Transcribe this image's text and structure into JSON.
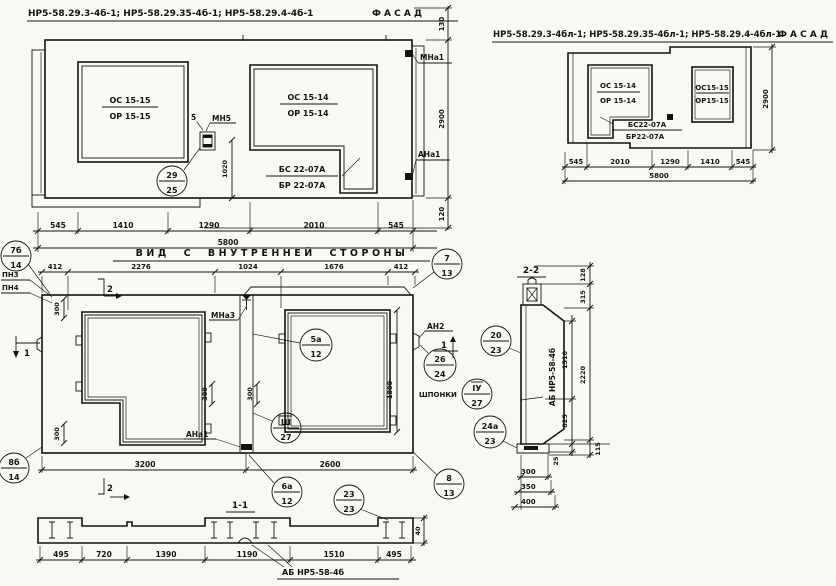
{
  "f1": {
    "title": "НР5-58.29.3-4б-1; НР5-58.29.35-4б-1; НР5-58.29.4-4б-1",
    "fasad": "Ф А С А Д",
    "w1a": "ОС 15-15",
    "w1b": "ОР 15-15",
    "w2a": "ОС 15-14",
    "w2b": "ОР 15-14",
    "sa": "БС 22-07А",
    "sb": "БР 22-07А",
    "mn5": "МН5",
    "n5": "5",
    "mna1": "МНа1",
    "ana1": "АНа1",
    "dims": [
      "545",
      "1410",
      "1290",
      "2010",
      "545"
    ],
    "total": "5800",
    "d130": "130",
    "d2900": "2900",
    "d120": "120",
    "d1020": "1020",
    "c29": {
      "a": "29",
      "b": "25"
    }
  },
  "f2": {
    "title": "НР5-58.29.3-4бл-1; НР5-58.29.35-4бл-1; НР5-58.29.4-4бл-1",
    "fasad": "Ф А С А Д",
    "w1a": "ОС 15-14",
    "w1b": "ОР 15-14",
    "w2a": "ОС15-15",
    "w2b": "ОР15-15",
    "sa": "БС22-07А",
    "sb": "БР22-07А",
    "dims": [
      "545",
      "2010",
      "1290",
      "1410",
      "545"
    ],
    "total": "5800",
    "d2900": "2900"
  },
  "iv": {
    "title": "ВИД С ВНУТРЕННЕЙ СТОРОНЫ",
    "dt": [
      "412",
      "2276",
      "1024",
      "1676",
      "412"
    ],
    "db": [
      "3200",
      "2600"
    ],
    "d1800": "1800",
    "d300": "300",
    "pn3": "ПН3",
    "pn4": "ПН4",
    "mna3": "МНа3",
    "ana1": "АНа1",
    "an2": "АН2",
    "shponki": "ШПОНКИ",
    "s1": "1",
    "s2": "2",
    "c7b": {
      "a": "7б",
      "b": "14"
    },
    "c8b": {
      "a": "8б",
      "b": "14"
    },
    "c7": {
      "a": "7",
      "b": "13"
    },
    "c8": {
      "a": "8",
      "b": "13"
    },
    "c5a": {
      "a": "5а",
      "b": "12"
    },
    "c3": {
      "a": "Ш",
      "b": "27"
    },
    "c6a": {
      "a": "6а",
      "b": "12"
    },
    "c23": {
      "a": "23",
      "b": "23"
    },
    "c26": {
      "a": "26",
      "b": "24"
    },
    "c4": {
      "a": "ІУ",
      "b": "27"
    },
    "c20": {
      "a": "20",
      "b": "23"
    },
    "c24a": {
      "a": "24а",
      "b": "23"
    }
  },
  "s22": {
    "title": "2-2",
    "mark": "АБ НР5-58-4б",
    "d128": "128",
    "d315": "315",
    "d2220": "2220",
    "d115": "115",
    "d1510": "1510",
    "d825": "825",
    "d25": "25",
    "d300": "300",
    "d350": "350",
    "d400": "400"
  },
  "s11": {
    "title": "1-1",
    "mark": "АБ НР5-58-4б",
    "dims": [
      "495",
      "720",
      "1390",
      "1190",
      "1510",
      "495"
    ],
    "d40": "40"
  }
}
